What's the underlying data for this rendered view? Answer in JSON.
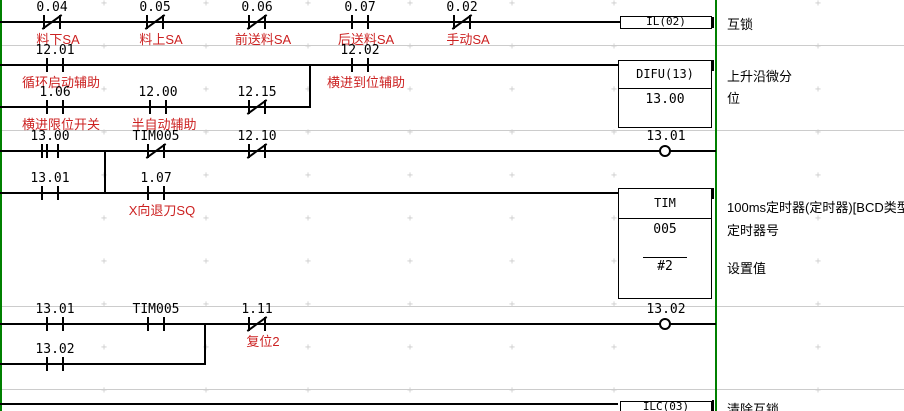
{
  "colors": {
    "background": "#ffffff",
    "rail": "#008000",
    "wire": "#000000",
    "comment": "#cc2222",
    "annotation": "#000000",
    "separator": "#cccccc",
    "grid": "#cccccc"
  },
  "rungs": {
    "r1": {
      "contacts": [
        {
          "address": "0.04",
          "comment": "料下SA"
        },
        {
          "address": "0.05",
          "comment": "料上SA"
        },
        {
          "address": "0.06",
          "comment": "前送料SA"
        },
        {
          "address": "0.07",
          "comment": "后送料SA"
        },
        {
          "address": "0.02",
          "comment": "手动SA"
        }
      ],
      "instruction": "IL(02)",
      "annotation": "互锁"
    },
    "r2": {
      "contacts": [
        {
          "address": "12.01",
          "comment": "循环启动辅助"
        },
        {
          "address": "12.02",
          "comment": "横进到位辅助"
        },
        {
          "address": "1.06",
          "comment": "横进限位开关"
        },
        {
          "address": "12.00",
          "comment": "半自动辅助"
        },
        {
          "address": "12.15"
        }
      ],
      "block": {
        "title": "DIFU(13)",
        "operand": "13.00"
      },
      "annotation_line1": "上升沿微分",
      "annotation_line2": "位"
    },
    "r3": {
      "contacts": [
        {
          "address": "13.00"
        },
        {
          "address": "TIM005"
        },
        {
          "address": "12.10"
        },
        {
          "address": "13.01"
        },
        {
          "address": "1.07",
          "comment": "X向退刀SQ"
        }
      ],
      "coil": {
        "address": "13.01"
      },
      "block": {
        "title": "TIM",
        "timer_number": "005",
        "set_value": "#2"
      },
      "annotation_title": "100ms定时器(定时器)[BCD类型]",
      "annotation_number": "定时器号",
      "annotation_value": "设置值"
    },
    "r4": {
      "contacts": [
        {
          "address": "13.01"
        },
        {
          "address": "TIM005"
        },
        {
          "address": "1.11",
          "comment": "复位2"
        },
        {
          "address": "13.02"
        }
      ],
      "coil": {
        "address": "13.02"
      }
    },
    "r5": {
      "instruction": "ILC(03)",
      "annotation": "清除互锁"
    }
  }
}
